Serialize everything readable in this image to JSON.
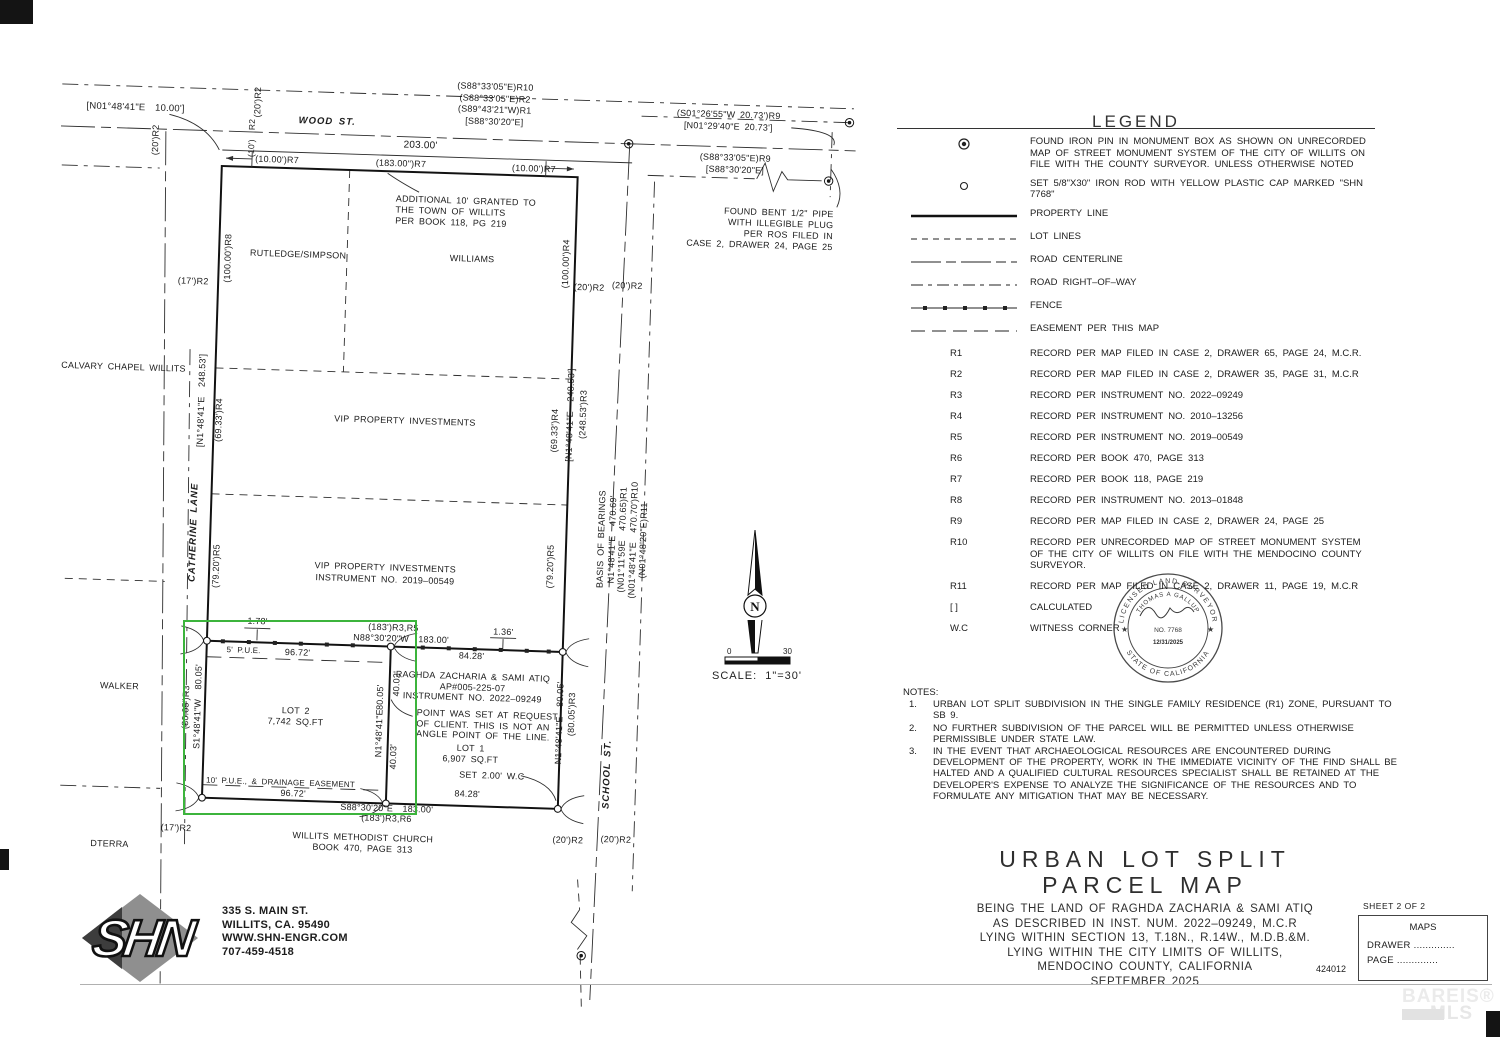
{
  "page": {
    "job_number": "424012",
    "watermark_line1": "BAREIS",
    "watermark_reg": "®",
    "watermark_line2": "MLS"
  },
  "highlight": {
    "color": "#3cb43c"
  },
  "compass": {
    "north_label": "N",
    "scale_tick_left": "0",
    "scale_tick_right": "30",
    "scale_label": "SCALE:  1\"=30'"
  },
  "seal": {
    "arc_top": "LICENSED LAND SURVEYOR",
    "name_arc": "THOMAS A GALLUP",
    "number": "NO. 7768",
    "date": "12/31/2025",
    "arc_bottom": "STATE OF CALIFORNIA",
    "star_left": "★",
    "star_right": "★"
  },
  "legend": {
    "title": "LEGEND",
    "items": [
      {
        "symbol": "found-pin",
        "text": "FOUND IRON PIN IN MONUMENT BOX AS SHOWN ON UNRECORDED MAP OF STREET MONUMENT SYSTEM OF THE CITY OF WILLITS ON FILE WITH THE COUNTY SURVEYOR. UNLESS OTHERWISE NOTED"
      },
      {
        "symbol": "set-rod",
        "text": "SET 5/8\"X30\" IRON ROD WITH YELLOW PLASTIC CAP MARKED \"SHN 7768\""
      },
      {
        "symbol": "property-line",
        "text": "PROPERTY LINE"
      },
      {
        "symbol": "lot-line",
        "text": "LOT LINES"
      },
      {
        "symbol": "road-centerline",
        "text": "ROAD CENTERLINE"
      },
      {
        "symbol": "road-row",
        "text": "ROAD RIGHT–OF–WAY"
      },
      {
        "symbol": "fence",
        "text": "FENCE"
      },
      {
        "symbol": "easement",
        "text": "EASEMENT PER THIS MAP"
      }
    ],
    "refs": [
      [
        "R1",
        "RECORD PER MAP FILED IN CASE 2, DRAWER 65, PAGE 24, M.C.R."
      ],
      [
        "R2",
        "RECORD PER MAP FILED IN CASE 2, DRAWER 35, PAGE 31, M.C.R"
      ],
      [
        "R3",
        "RECORD PER INSTRUMENT NO. 2022–09249"
      ],
      [
        "R4",
        "RECORD PER INSTRUMENT NO. 2010–13256"
      ],
      [
        "R5",
        "RECORD PER INSTRUMENT NO. 2019–00549"
      ],
      [
        "R6",
        "RECORD PER BOOK 470, PAGE 313"
      ],
      [
        "R7",
        "RECORD PER BOOK 118, PAGE 219"
      ],
      [
        "R8",
        "RECORD PER INSTRUMENT NO. 2013–01848"
      ],
      [
        "R9",
        "RECORD PER MAP FILED IN CASE 2, DRAWER 24, PAGE 25"
      ],
      [
        "R10",
        "RECORD PER UNRECORDED MAP OF STREET MONUMENT SYSTEM OF THE CITY OF WILLITS ON FILE WITH THE MENDOCINO COUNTY SURVEYOR."
      ],
      [
        "R11",
        "RECORD PER MAP FILED IN CASE 2, DRAWER 11, PAGE 19, M.C.R"
      ],
      [
        "[ ]",
        "CALCULATED"
      ],
      [
        "W.C",
        "WITNESS CORNER"
      ]
    ]
  },
  "notes": {
    "title": "NOTES:",
    "items": [
      "URBAN LOT SPLIT SUBDIVISION IN THE SINGLE FAMILY RESIDENCE (R1) ZONE, PURSUANT TO SB 9.",
      "NO FURTHER SUBDIVISION OF THE PARCEL WILL BE PERMITTED UNLESS OTHERWISE PERMISSIBLE UNDER STATE LAW.",
      "IN THE EVENT THAT ARCHAEOLOGICAL RESOURCES ARE ENCOUNTERED DURING DEVELOPMENT OF THE PROPERTY, WORK IN THE IMMEDIATE VICINITY OF THE FIND SHALL BE HALTED AND A QUALIFIED CULTURAL RESOURCES SPECIALIST SHALL BE RETAINED AT THE DEVELOPER'S EXPENSE TO ANALYZE THE SIGNIFICANCE OF THE RESOURCES AND TO FORMULATE ANY MITIGATION THAT MAY BE NECESSARY."
    ]
  },
  "title_block": {
    "title1": "URBAN LOT SPLIT",
    "title2": "PARCEL MAP",
    "lines": [
      "BEING THE LAND OF RAGHDA ZACHARIA & SAMI ATIQ",
      "AS DESCRIBED IN INST. NUM. 2022–09249, M.C.R",
      "LYING WITHIN SECTION 13, T.18N., R.14W., M.D.B.&M.",
      "LYING WITHIN THE CITY LIMITS OF WILLITS,",
      "MENDOCINO COUNTY, CALIFORNIA",
      "SEPTEMBER 2025"
    ]
  },
  "sheet_box": {
    "sheet_label": "SHEET 2 OF 2",
    "maps_label": "MAPS",
    "drawer_label": "DRAWER",
    "page_label": "PAGE",
    "dots": ".............."
  },
  "logo": {
    "name": "SHN",
    "address": [
      "335 S. MAIN ST.",
      "WILLITS, CA. 95490",
      "WWW.SHN-ENGR.COM",
      "707-459-4518"
    ]
  },
  "map": {
    "labels": [
      {
        "t": "WOOD ST.",
        "x": 326,
        "y": 119,
        "st": "i",
        "s": 9.5,
        "ls": 1
      },
      {
        "t": "203.00'",
        "x": 420,
        "y": 140,
        "s": 10
      },
      {
        "t": "[N01°48'41\"E  10.00']",
        "x": 134,
        "y": 111,
        "s": 9.5
      },
      {
        "t": "(20')R2",
        "x": 155,
        "y": 142,
        "r": -90
      },
      {
        "t": "(20')R2",
        "x": 256,
        "y": 101,
        "r": -90
      },
      {
        "t": "(10')  R2",
        "x": 251,
        "y": 137,
        "r": -90,
        "s": 8.5
      },
      {
        "t": "(S88°33'05\"E)R10\n(S88°33'05\"E)R2\n(S89°43'21\"W)R1\n[S88°30'20\"E]",
        "x": 493,
        "y": 96,
        "lh": 11.5
      },
      {
        "t": "(S01°26'55\"W 20.73')R9\n[N01°29'40\"E 20.73']",
        "x": 727,
        "y": 105,
        "lh": 11.5
      },
      {
        "t": "(S88°33'05\"E)R9\n[S88°30'20\"E]",
        "x": 735,
        "y": 148,
        "lh": 11.5
      },
      {
        "t": "FOUND BENT 1/2\" PIPE\nWITH ILLEGIBLE PLUG\nPER ROS FILED IN\nCASE 2, DRAWER 24, PAGE 25",
        "x": 835,
        "y": 190,
        "a": "r",
        "lh": 11
      },
      {
        "t": "(10.00')R7",
        "x": 277,
        "y": 158
      },
      {
        "t": "(183.00\")R7",
        "x": 401,
        "y": 158
      },
      {
        "t": "(10.00')R7",
        "x": 534,
        "y": 159
      },
      {
        "t": "ADDITIONAL 10' GRANTED TO\nTHE TOWN OF WILLITS\nPER BOOK 118, PG 219",
        "x": 397,
        "y": 188,
        "a": "l",
        "lh": 11
      },
      {
        "t": "RUTLEDGE/SIMPSON",
        "x": 301,
        "y": 252
      },
      {
        "t": "WILLIAMS",
        "x": 475,
        "y": 251
      },
      {
        "t": "(100.00')R8",
        "x": 231,
        "y": 258,
        "r": -90
      },
      {
        "t": "(100.00')R4",
        "x": 569,
        "y": 253,
        "r": -90
      },
      {
        "t": "(17')R2",
        "x": 197,
        "y": 282
      },
      {
        "t": "(20')R2",
        "x": 593,
        "y": 276
      },
      {
        "t": "(20')R2",
        "x": 631,
        "y": 273
      },
      {
        "t": "CALVARY CHAPEL WILLITS",
        "x": 130,
        "y": 370
      },
      {
        "t": "[N1°48'41\"E  248.53']",
        "x": 209,
        "y": 401,
        "r": -90
      },
      {
        "t": "(69.33')R4",
        "x": 227,
        "y": 420,
        "r": -90
      },
      {
        "t": "VIP PROPERTY INVESTMENTS",
        "x": 413,
        "y": 415
      },
      {
        "t": "(69.33')R4",
        "x": 563,
        "y": 420,
        "r": -90
      },
      {
        "t": "[N1°48'41\"E  248.53']",
        "x": 578,
        "y": 404,
        "r": -90
      },
      {
        "t": "(248.53')R3",
        "x": 591,
        "y": 403,
        "r": -90
      },
      {
        "t": "CATHERINE LANE",
        "x": 206,
        "y": 533,
        "r": -90,
        "st": "i",
        "s": 9.5,
        "ls": 1
      },
      {
        "t": "(79.20')R5",
        "x": 229,
        "y": 566,
        "r": -90
      },
      {
        "t": "VIP PROPERTY INVESTMENTS\nINSTRUMENT NO. 2019–00549",
        "x": 398,
        "y": 568,
        "lh": 12
      },
      {
        "t": "(79.20')R5",
        "x": 563,
        "y": 556,
        "r": -90
      },
      {
        "t": "BASIS OF BEARINGS\nN1°48'41\"E  470.69'\n(N01°11'59E  470.65)R1\n(N01°48'41\"E  470.70')R10\n(N01°48'20\"E)R11",
        "x": 634,
        "y": 527,
        "r": -90,
        "lh": 10.5
      },
      {
        "t": "1.78'",
        "x": 272,
        "y": 620
      },
      {
        "t": "(183')R3,R5",
        "x": 408,
        "y": 622
      },
      {
        "t": "N88°30'20\"W  183.00'",
        "x": 416,
        "y": 633
      },
      {
        "t": "1.36'",
        "x": 518,
        "y": 623
      },
      {
        "t": "5' P.U.E.",
        "x": 259,
        "y": 650,
        "s": 8
      },
      {
        "t": "96.72'",
        "x": 313,
        "y": 650
      },
      {
        "t": "84.28'",
        "x": 487,
        "y": 648
      },
      {
        "t": "RAGHDA ZACHARIA & SAMI ATIQ\nAP#005-225-07\nINSTRUMENT NO. 2022–09249",
        "x": 489,
        "y": 679,
        "lh": 10.5
      },
      {
        "t": "80.05'",
        "x": 397,
        "y": 692,
        "r": -90
      },
      {
        "t": "40.02'",
        "x": 413,
        "y": 678,
        "r": -90
      },
      {
        "t": "LOT 2\n7,742 SQ.FT",
        "x": 313,
        "y": 714,
        "lh": 11
      },
      {
        "t": "S1°48'41\"W  80.05'",
        "x": 215,
        "y": 707,
        "r": -90
      },
      {
        "t": "(80.05')R3",
        "x": 203,
        "y": 708,
        "r": -90
      },
      {
        "t": "POINT WAS SET AT REQUEST\nOF CLIENT. THIS IS NOT AN\nANGLE POINT OF THE LINE.",
        "x": 434,
        "y": 701,
        "a": "l",
        "lh": 10.5
      },
      {
        "t": "N1°48'41\"E",
        "x": 397,
        "y": 728,
        "r": -90
      },
      {
        "t": "40.03'",
        "x": 412,
        "y": 751,
        "r": -90
      },
      {
        "t": "LOT 1\n6,907 SQ.FT",
        "x": 489,
        "y": 746,
        "lh": 11
      },
      {
        "t": "SET 2.00' W.C",
        "x": 511,
        "y": 767
      },
      {
        "t": "10' P.U.E., & DRAINAGE EASEMENT",
        "x": 300,
        "y": 781,
        "s": 8
      },
      {
        "t": "96.72'",
        "x": 313,
        "y": 791
      },
      {
        "t": "84.28'",
        "x": 487,
        "y": 786
      },
      {
        "t": "S88°30'20\"E  183.00'",
        "x": 407,
        "y": 803
      },
      {
        "t": "(183')R3,R6",
        "x": 407,
        "y": 813
      },
      {
        "t": "N1°48'41\"E  80.05'",
        "x": 577,
        "y": 712,
        "r": -90
      },
      {
        "t": "(80.05')R3",
        "x": 589,
        "y": 703,
        "r": -90
      },
      {
        "t": "SCHOOL ST.",
        "x": 627,
        "y": 762,
        "r": -90,
        "st": "i",
        "s": 9.5,
        "ls": 1
      },
      {
        "t": "(17')R2",
        "x": 197,
        "y": 829
      },
      {
        "t": "WILLITS METHODIST CHURCH\nBOOK 470, PAGE 313",
        "x": 384,
        "y": 838,
        "lh": 10.5
      },
      {
        "t": "(20')R2",
        "x": 589,
        "y": 829
      },
      {
        "t": "(20')R2",
        "x": 637,
        "y": 827
      },
      {
        "t": "DTERRA",
        "x": 131,
        "y": 847
      },
      {
        "t": "WALKER",
        "x": 136,
        "y": 689
      }
    ]
  }
}
